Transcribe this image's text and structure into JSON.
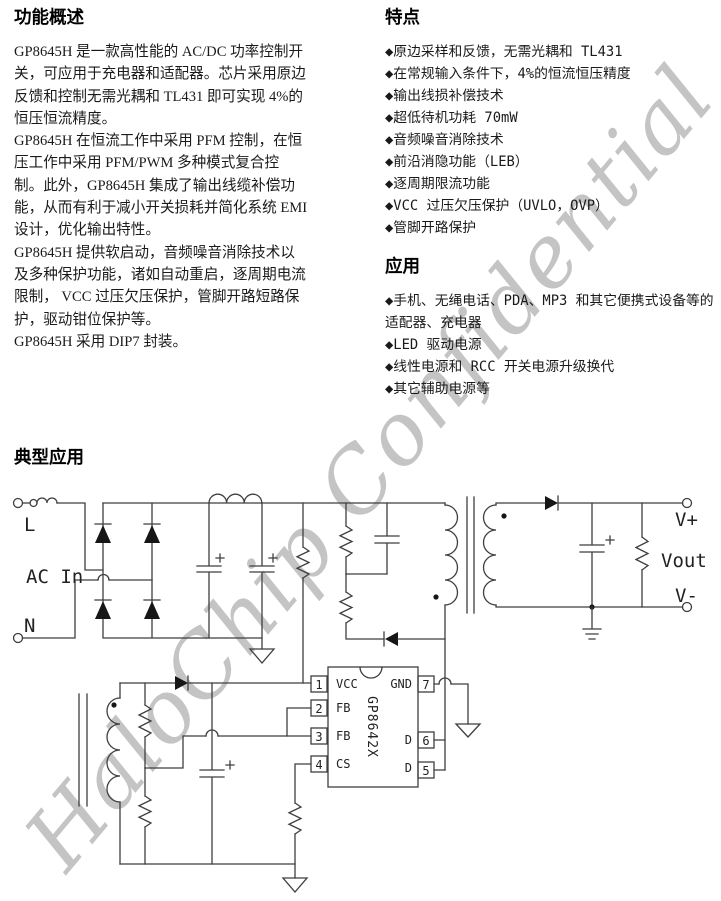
{
  "watermark": {
    "text": "HaloChip Confidential",
    "color": "#c4c4c4"
  },
  "overview": {
    "title": "功能概述",
    "lines": [
      "GP8645H 是一款高性能的 AC/DC 功率控制开",
      "关，可应用于充电器和适配器。芯片采用原边",
      "反馈和控制无需光耦和 TL431 即可实现 4%的",
      "恒压恒流精度。",
      "GP8645H 在恒流工作中采用 PFM 控制，在恒",
      "压工作中采用 PFM/PWM 多种模式复合控",
      "制。此外，GP8645H 集成了输出线缆补偿功",
      "能，从而有利于减小开关损耗并简化系统 EMI",
      "设计，优化输出特性。",
      "GP8645H 提供软启动，音频噪音消除技术以",
      "及多种保护功能，诸如自动重启，逐周期电流",
      "限制， VCC 过压欠压保护，管脚开路短路保",
      "护，驱动钳位保护等。",
      "GP8645H 采用 DIP7 封装。"
    ]
  },
  "features": {
    "title": "特点",
    "items": [
      "◆原边采样和反馈，无需光耦和 TL431",
      "◆在常规输入条件下，4%的恒流恒压精度",
      "◆输出线损补偿技术",
      "◆超低待机功耗 70mW",
      "◆音频噪音消除技术",
      "◆前沿消隐功能（LEB）",
      "◆逐周期限流功能",
      "◆VCC 过压欠压保护（UVLO，OVP）",
      "◆管脚开路保护"
    ]
  },
  "applications": {
    "title": "应用",
    "items": [
      "◆手机、无绳电话、PDA、MP3 和其它便携式设备等的适配器、充电器",
      "◆LED 驱动电源",
      "◆线性电源和 RCC 开关电源升级换代",
      "◆其它辅助电源等"
    ]
  },
  "typical_application": {
    "title": "典型应用"
  },
  "circuit": {
    "labels": {
      "l": "L",
      "ac_in": "AC In",
      "n": "N",
      "vplus": "V+",
      "vout": "Vout",
      "vminus": "V-"
    },
    "ic": {
      "part": "GP8642X",
      "pins_left": [
        {
          "num": "1",
          "name": "VCC"
        },
        {
          "num": "2",
          "name": "FB"
        },
        {
          "num": "3",
          "name": "FB"
        },
        {
          "num": "4",
          "name": "CS"
        }
      ],
      "pins_right": [
        {
          "num": "7",
          "name": "GND"
        },
        {
          "num": "6",
          "name": "D"
        },
        {
          "num": "5",
          "name": "D"
        }
      ]
    }
  }
}
